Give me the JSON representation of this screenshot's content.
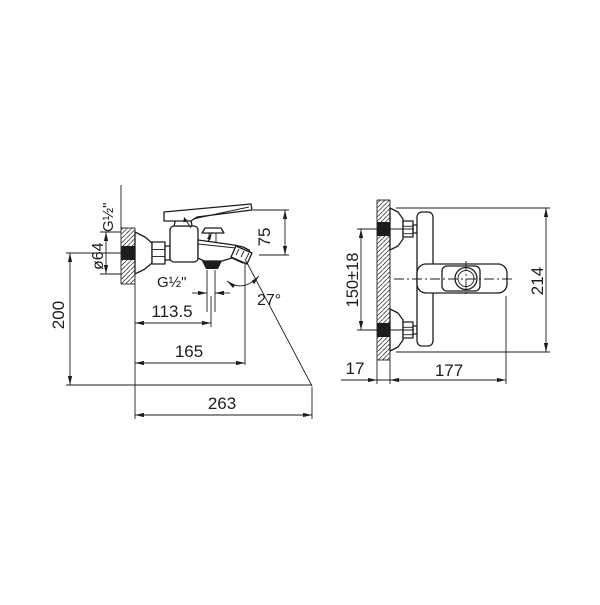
{
  "drawing": {
    "background_color": "#ffffff",
    "line_color": "#1d1d1b",
    "subject": "wall-mounted bath mixer faucet technical drawing, two orthographic views",
    "views": {
      "side": {
        "name": "side view",
        "labels": {
          "inlet_thread": "G½\"",
          "flange_diameter": "ø64",
          "handle_height": "75",
          "outlet_thread": "G½\"",
          "spout_angle": "27°",
          "wall_to_outlet": "113.5",
          "wall_to_spout_tip": "165",
          "mount_height": "200",
          "max_reach": "263"
        }
      },
      "top": {
        "name": "top view",
        "labels": {
          "inlet_spacing": "150±18",
          "overall_length": "214",
          "wall_depth": "17",
          "body_projection": "177"
        }
      }
    }
  }
}
